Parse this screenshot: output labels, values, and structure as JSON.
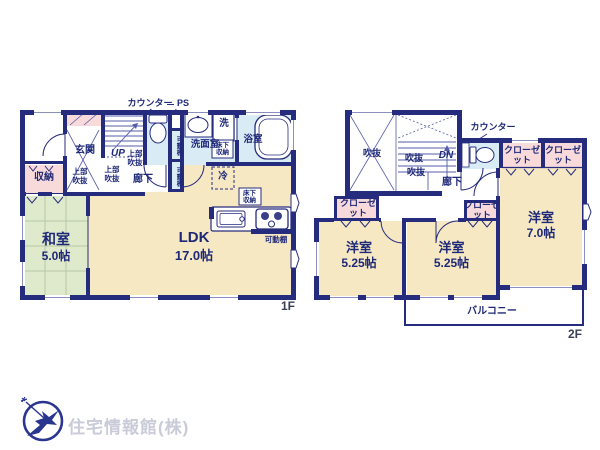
{
  "floor1": {
    "counter_label": "カウンター",
    "ps_label": "PS",
    "genkan": "玄関",
    "up": "UP",
    "upper_void": "上部吹抜",
    "hallway": "廊下",
    "storage": "収納",
    "movable_shelf": "可動棚",
    "washroom": "洗面室",
    "underfloor_storage": "床下収納",
    "laundry": "洗",
    "bathroom": "浴室",
    "fridge": "冷",
    "tatami_room": {
      "name": "和室",
      "size": "5.0帖"
    },
    "ldk": {
      "name": "LDK",
      "size": "17.0帖"
    },
    "floor_tag": "1F"
  },
  "floor2": {
    "void_label": "吹抜",
    "dn": "DN",
    "counter_label": "カウンター",
    "closet": "クローゼット",
    "hallway": "廊下",
    "bedroom_left": {
      "name": "洋室",
      "size": "5.25帖"
    },
    "bedroom_mid": {
      "name": "洋室",
      "size": "5.25帖"
    },
    "bedroom_right": {
      "name": "洋室",
      "size": "7.0帖"
    },
    "balcony": "バルコニー",
    "floor_tag": "2F"
  },
  "logo": {
    "company": "住宅情報館(株)"
  },
  "colors": {
    "wall": "#262c7d",
    "room_cream": "#f6e8c3",
    "tatami_green": "#dfe9cb",
    "closet_pink": "#f8dadb",
    "wet_area_blue": "#d9ecf5",
    "label_navy": "#1e2878",
    "logo_text_gray": "#c9cbd8",
    "logo_mark_navy": "#2a3590"
  }
}
